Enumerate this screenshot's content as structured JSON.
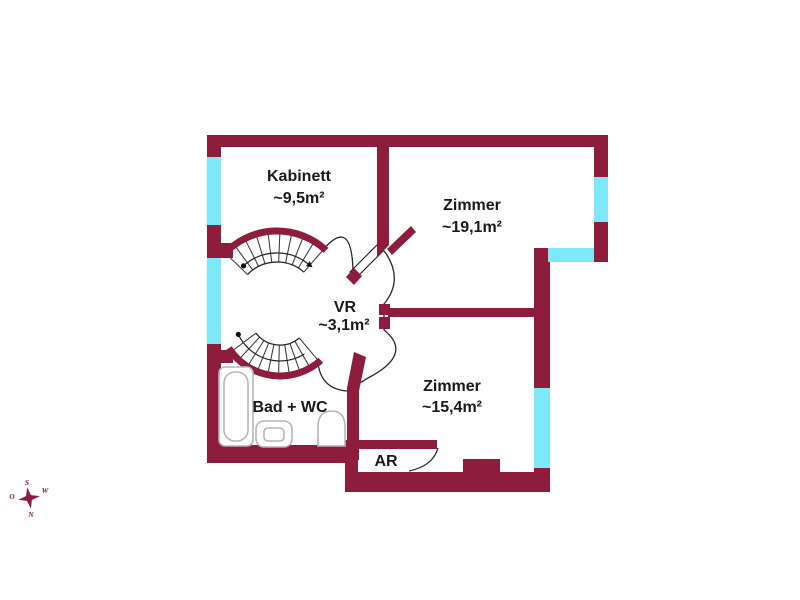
{
  "plan": {
    "rooms": [
      {
        "name": "Kabinett",
        "area": "~9,5m²"
      },
      {
        "name": "Zimmer",
        "area": "~19,1m²"
      },
      {
        "name": "VR",
        "area": "~3,1m²"
      },
      {
        "name": "Zimmer",
        "area": "~15,4m²"
      },
      {
        "name": "Bad + WC",
        "area": ""
      },
      {
        "name": "AR",
        "area": ""
      }
    ],
    "compass": {
      "north": "N",
      "south": "S",
      "east": "O",
      "west": "W"
    },
    "colors": {
      "wall": "#8e1c3c",
      "window": "#7de8f8",
      "line": "#2a2a2a",
      "fixture": "#b5b5b5",
      "text": "#1a1a1a"
    }
  }
}
